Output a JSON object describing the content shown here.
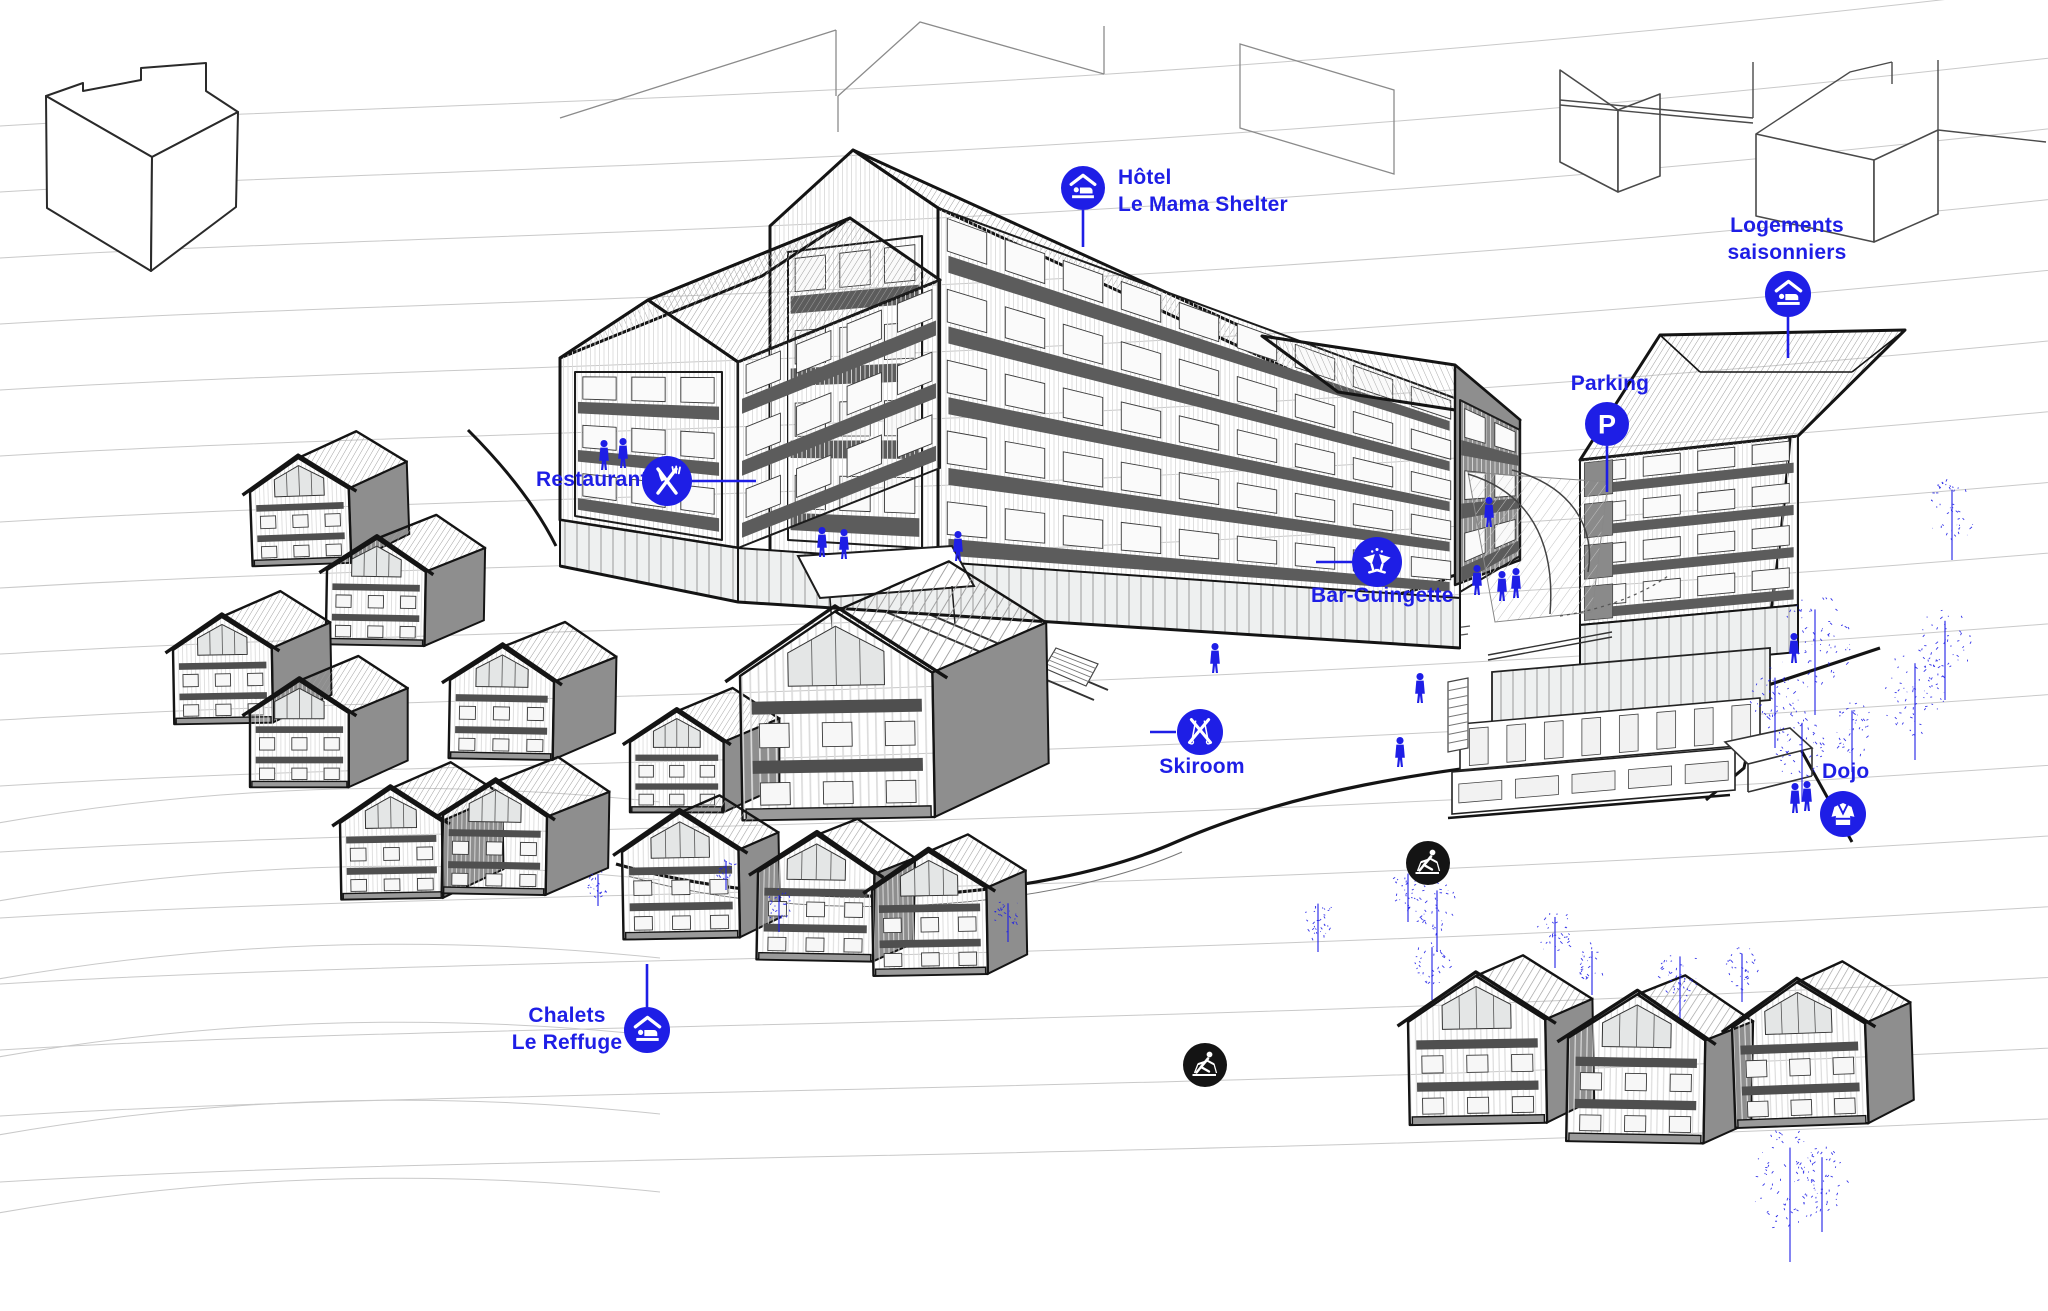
{
  "colors": {
    "accent": "#1E1EE6",
    "badge": "#141414"
  },
  "labels": {
    "hotel": {
      "line1": "Hôtel",
      "line2": "Le Mama Shelter"
    },
    "logements": {
      "line1": "Logements",
      "line2": "saisonniers"
    },
    "parking": {
      "line1": "Parking"
    },
    "restaurant": {
      "line1": "Restaurant"
    },
    "bar": {
      "line1": "Bar-Guingette"
    },
    "skiroom": {
      "line1": "Skiroom"
    },
    "dojo": {
      "line1": "Dojo"
    },
    "chalets": {
      "line1": "Chalets",
      "line2": "Le Reffuge"
    }
  },
  "glyphs": {
    "parking": "P"
  }
}
